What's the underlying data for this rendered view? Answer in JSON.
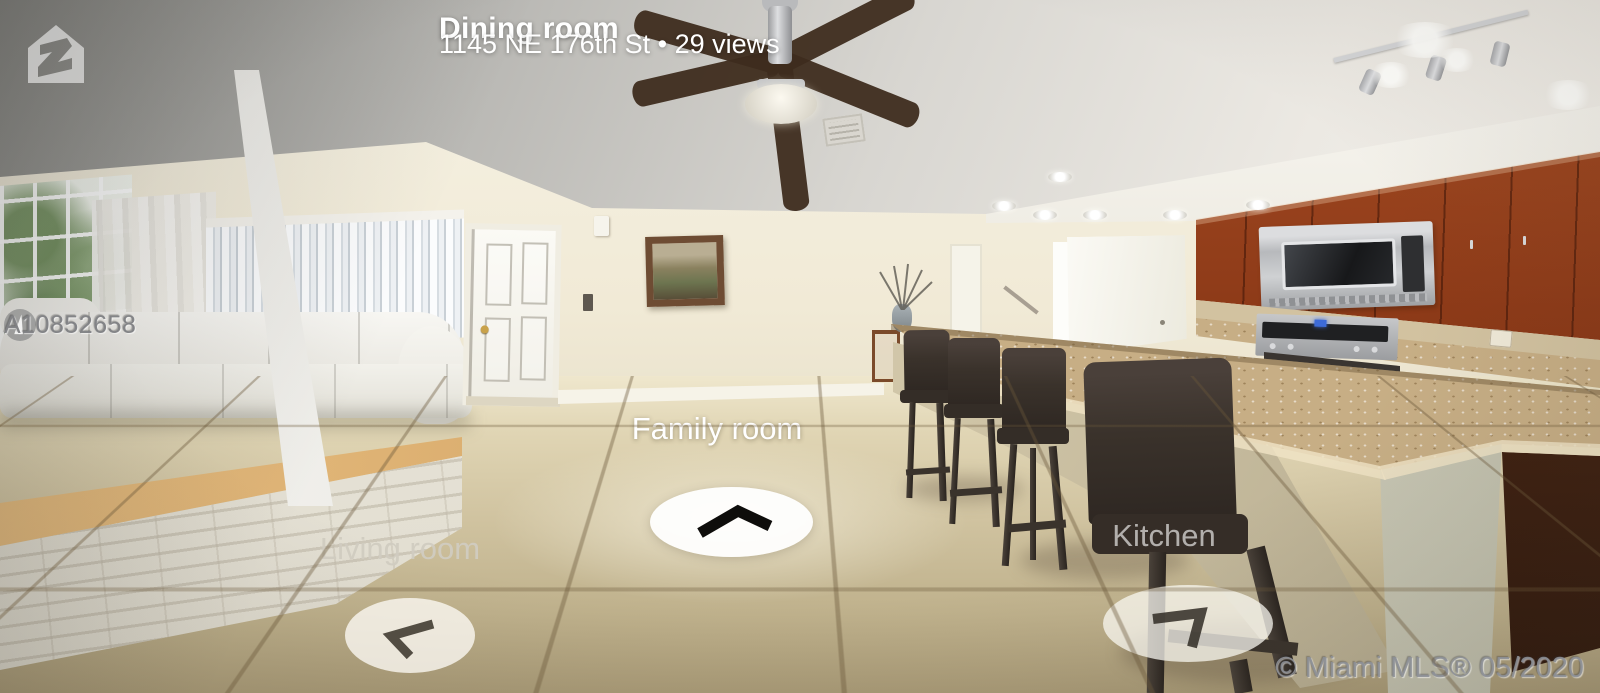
{
  "viewer": {
    "title": "Dining room",
    "subtitle": "1145 NE 176th St • 29 views",
    "logo_icon": "zillow-house-logo"
  },
  "hotspots": [
    {
      "label": "Family room",
      "icon": "chevron-up",
      "state": "active"
    },
    {
      "label": "Living room",
      "icon": "chevron-up-left",
      "state": "dimmed"
    },
    {
      "label": "Kitchen",
      "icon": "chevron-right-down",
      "state": "dimmed"
    }
  ],
  "watermarks": {
    "listing_id": "A10852658",
    "listing_icon": "mls-circle-logo",
    "copyright": "© Miami MLS® 05/2020"
  },
  "colors": {
    "hotspot_disc": "#ffffff",
    "hotspot_label": "#ffffff",
    "cabinet_wood": "#8d3a18",
    "floor_tile": "#d0c3a0",
    "granite": "#c7ae85",
    "watermark_gray": "#8c9096"
  }
}
